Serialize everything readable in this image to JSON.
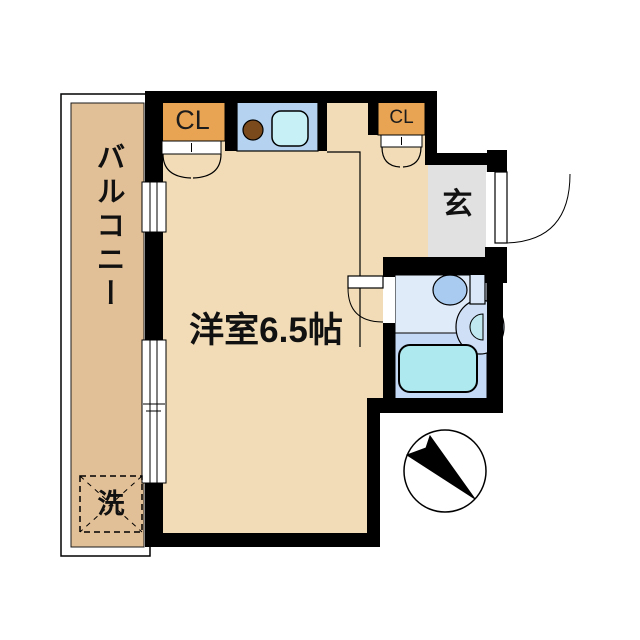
{
  "plan": {
    "labels": {
      "room": "洋室6.5帖",
      "balcony": "バルコニー",
      "entrance": "玄",
      "closet_left": "CL",
      "closet_right": "CL",
      "washer": "洗"
    },
    "colors": {
      "floor": "#f1dcb7",
      "balcony": "#e2c097",
      "closet": "#e9a453",
      "kitchen": "#b5d3f0",
      "kitchen_sink": "#c7f0f6",
      "burner": "#7a4a1c",
      "entrance_floor": "#e1e1e1",
      "bath_upper": "#e0ebf9",
      "bath_lower": "#c3d9f5",
      "bathtub": "#aee9f0",
      "toilet_bowl": "#a9cbf0",
      "toilet_tank": "#d9e7f8",
      "basin": "#cfe0f6",
      "basin_inner": "#bfe8f0",
      "wall": "#000000",
      "white": "#ffffff"
    }
  }
}
